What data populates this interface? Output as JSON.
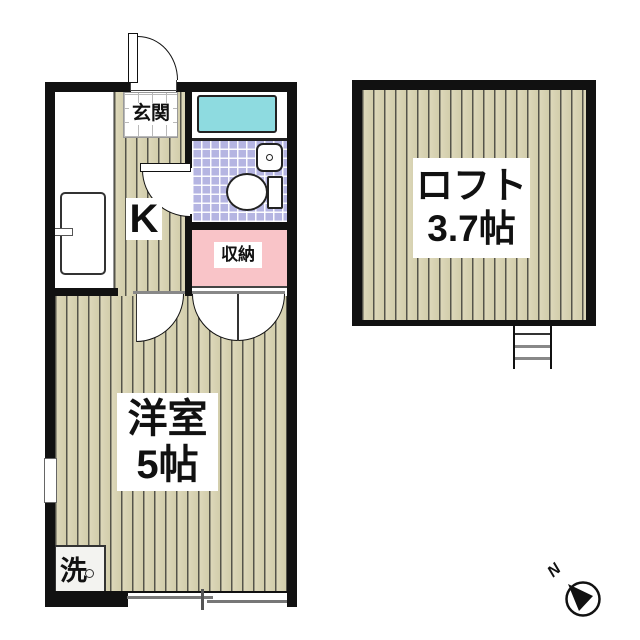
{
  "unit": {
    "entrance_label": "玄関",
    "kitchen_label": "K",
    "closet_label": "収納",
    "room_label_line1": "洋室",
    "room_label_line2": "5帖",
    "washer_label": "洗"
  },
  "loft": {
    "label_line1": "ロフト",
    "label_line2": "3.7帖"
  },
  "compass": {
    "north_label": "N"
  },
  "colors": {
    "wall": "#111111",
    "wood_floor": "#d2cdab",
    "plank_line": "#55544a",
    "bath_tile": "#b5b5e2",
    "bathtub": "#8edbe0",
    "closet_pink": "#f9c4c8",
    "entrance_tile": "#ffffff"
  }
}
